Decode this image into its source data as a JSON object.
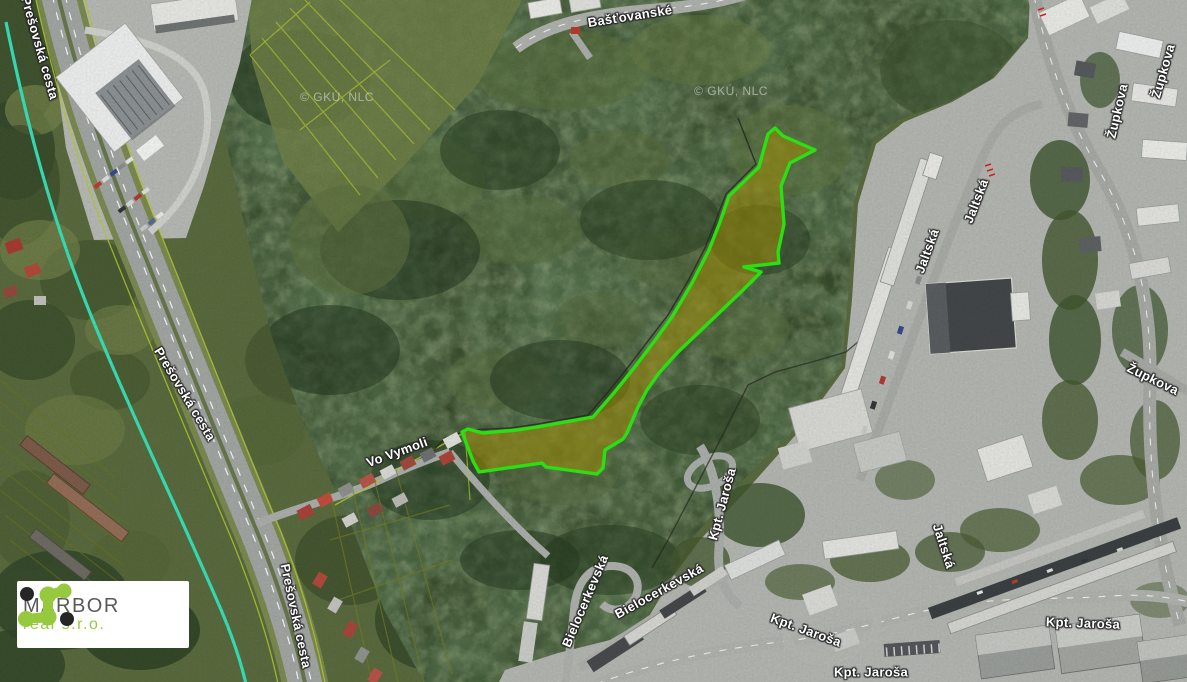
{
  "watermark": {
    "text": "© GKÚ, NLC"
  },
  "street_labels": [
    {
      "text": "Prešovská cesta",
      "x": 40,
      "y": 48,
      "rot": 74
    },
    {
      "text": "Prešovská cesta",
      "x": 185,
      "y": 394,
      "rot": 59
    },
    {
      "text": "Prešovská cesta",
      "x": 296,
      "y": 616,
      "rot": 78
    },
    {
      "text": "Bašťovanské",
      "x": 630,
      "y": 16,
      "rot": -9
    },
    {
      "text": "Vo Vymoli",
      "x": 397,
      "y": 452,
      "rot": -20
    },
    {
      "text": "Jaltská",
      "x": 927,
      "y": 251,
      "rot": -70
    },
    {
      "text": "Jaltská",
      "x": 976,
      "y": 201,
      "rot": -69
    },
    {
      "text": "Jaltská",
      "x": 944,
      "y": 546,
      "rot": 72
    },
    {
      "text": "Župkova",
      "x": 1117,
      "y": 111,
      "rot": -77
    },
    {
      "text": "Župkova",
      "x": 1163,
      "y": 71,
      "rot": -74
    },
    {
      "text": "Župkova",
      "x": 1153,
      "y": 379,
      "rot": 26
    },
    {
      "text": "Kpt. Jaroša",
      "x": 722,
      "y": 504,
      "rot": -75
    },
    {
      "text": "Kpt. Jaroša",
      "x": 806,
      "y": 630,
      "rot": 20
    },
    {
      "text": "Kpt. Jaroša",
      "x": 1083,
      "y": 623,
      "rot": 2
    },
    {
      "text": "Kpt. Jaroša",
      "x": 871,
      "y": 672,
      "rot": 0
    },
    {
      "text": "Bielocerkevská",
      "x": 585,
      "y": 601,
      "rot": -67
    },
    {
      "text": "Bielocerkevská",
      "x": 659,
      "y": 591,
      "rot": -29
    }
  ],
  "logo": {
    "company": "MARBOR",
    "suffix": "real s.r.o."
  },
  "colors": {
    "parcel_fill": "#a28d04",
    "parcel_outline": "#2bdf12",
    "utility_line": "#38dfb6",
    "cadastral_line": "#b5c92c",
    "logo_green": "#96c93d",
    "logo_dark": "#262626"
  }
}
